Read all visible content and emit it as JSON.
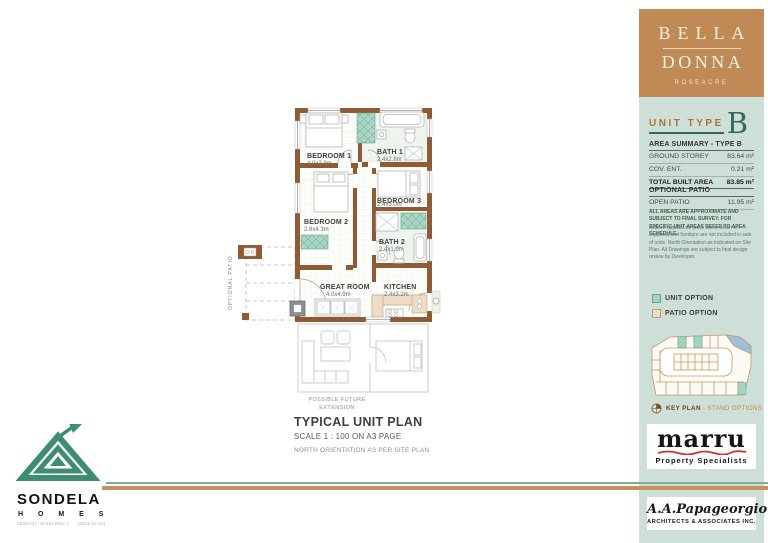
{
  "floor_plan": {
    "rooms": [
      {
        "name": "BEDROOM 1",
        "dims": "4.0x2.8m"
      },
      {
        "name": "BATH 1",
        "dims": "2.4x2.8m"
      },
      {
        "name": "BEDROOM 2",
        "dims": "2.8x4.3m"
      },
      {
        "name": "BEDROOM 3",
        "dims": "2.4x3.0m"
      },
      {
        "name": "BATH 2",
        "dims": "2.4x1.9m"
      },
      {
        "name": "GREAT ROOM",
        "dims": "4.0x4.9m"
      },
      {
        "name": "KITCHEN",
        "dims": "2.4x3.2m"
      }
    ],
    "optional_patio_label": "OPTIONAL PATIO",
    "future_extension": {
      "line1": "POSSIBLE FUTURE",
      "line2": "EXTENSION"
    }
  },
  "title_block": {
    "title": "TYPICAL UNIT PLAN",
    "scale": "SCALE  1 : 100 ON A3 PAGE",
    "north_note": "NORTH ORIENTATION AS PER SITE PLAN"
  },
  "sidebar": {
    "brand": {
      "line1": "BELLA",
      "line2": "DONNA",
      "subtitle": "ROSEACRE"
    },
    "unit_type": {
      "label": "UNIT TYPE",
      "letter": "B"
    },
    "area_summary": {
      "header": "AREA SUMMARY - TYPE B",
      "rows": [
        {
          "label": "GROUND STOREY",
          "value": "83.64 m²"
        },
        {
          "label": "COV. ENT.",
          "value": "0.21 m²"
        },
        {
          "label": "TOTAL BUILT AREA",
          "value": "83.85 m²"
        }
      ]
    },
    "optional_patio": {
      "header": "OPTIONAL PATIO",
      "rows": [
        {
          "label": "OPEN PATIO",
          "value": "11.95 m²"
        }
      ]
    },
    "disclaimer_primary": "ALL AREAS ARE APPROXIMATE AND SUBJECT TO FINAL SURVEY. FOR SPECIFIC UNIT AREAS REFER TO AREA SCHEDULE.",
    "disclaimer_secondary": "Kitchen appliances (excl. stove which is supplied) and furniture are not included in sale of units. North Orientation as indicated on Site Plan. All Drawings are subject to final design review by Developer.",
    "legend": {
      "unit_option": "UNIT OPTION",
      "patio_option": "PATIO OPTION"
    },
    "key_plan": {
      "label": "KEY PLAN",
      "suffix": "- STAND OPTIONS"
    },
    "marru": {
      "name": "marru",
      "tagline": "Property Specialists"
    },
    "architect": {
      "name": "A.A.Papageorgiou",
      "subtitle": "ARCHITECTS & ASSOCIATES INC."
    }
  },
  "footer": {
    "brand": "SONDELA",
    "brand_sub": "H O M E S",
    "doc_ref": "0533-047- M 610 REV J",
    "doc_date": "(2021-12-10)"
  },
  "colors": {
    "header_tan": "#BF8A55",
    "panel_mint": "#CEDFD7",
    "accent_orange": "#B06F35",
    "accent_green": "#2F6B5B",
    "wall_brown": "#8E5B34",
    "option_teal": "#9FD6C2",
    "keyplan_tan": "#C49A62",
    "marru_red": "#D0342C"
  }
}
